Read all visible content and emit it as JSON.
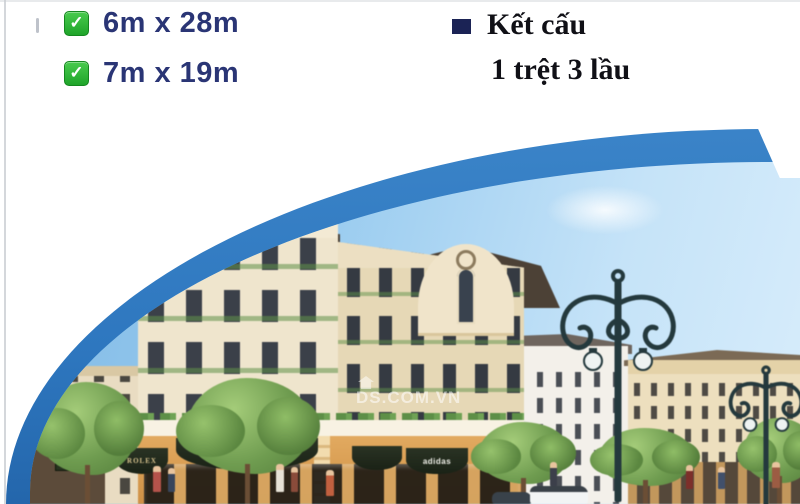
{
  "specs": {
    "check_glyph": "✓",
    "items": [
      {
        "label": "6m x 28m"
      },
      {
        "label": "7m x 19m"
      }
    ],
    "text_color": "#2a3575",
    "check_green": "#2eb135"
  },
  "structure_info": {
    "title": "Kết cấu",
    "subtitle": "1 trệt 3 lầu",
    "bullet_color": "#1b2355",
    "text_color": "#101016"
  },
  "ribbon": {
    "blue": "#2e77bf"
  },
  "scene": {
    "watermark_text": "DS.COM.VN",
    "signs": {
      "rolex": "ROLEX",
      "adidas": "adidas"
    },
    "sky_top": "#7fb9e5",
    "sky_bottom": "#d8edfb",
    "building_cream": "#efe5cd",
    "awning_green": "#1f2818",
    "shop_band_tan": "#dba25c"
  }
}
